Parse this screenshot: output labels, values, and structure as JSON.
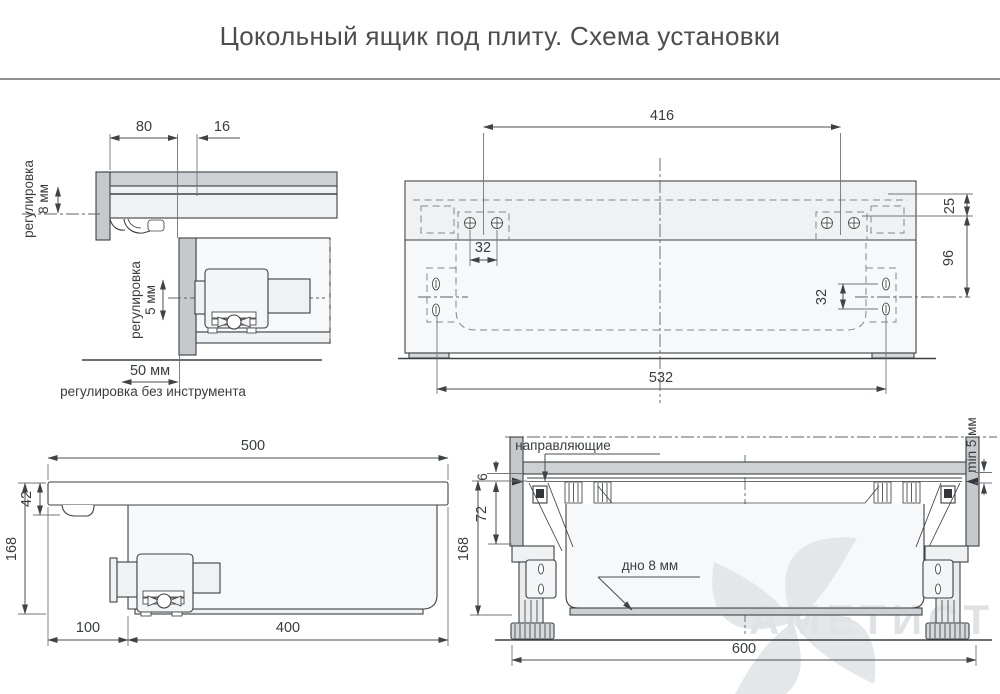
{
  "title": "Цокольный ящик под плиту. Схема установки",
  "colors": {
    "background": "#ffffff",
    "divider": "#8e8e8e",
    "line": "#3d4145",
    "dimension": "#4a4e51",
    "panel_fill": "#c6c9cb",
    "light_fill": "#eff1f2",
    "watermark": "#dfe3e6"
  },
  "side_detail": {
    "dim_80": "80",
    "dim_16": "16",
    "adjust_8mm_line1": "регулировка",
    "adjust_8mm_line2": "8 мм",
    "adjust_5mm_line1": "регулировка",
    "adjust_5mm_line2": "5 мм",
    "dim_50mm": "50 мм",
    "note_toolless": "регулировка без инструмента"
  },
  "top_view": {
    "dim_416": "416",
    "dim_25": "25",
    "dim_96": "96",
    "dim_32_horizontal": "32",
    "dim_32_vertical": "32",
    "dim_532": "532"
  },
  "side_view": {
    "dim_500": "500",
    "dim_42": "42",
    "dim_168": "168",
    "dim_100": "100",
    "dim_400": "400"
  },
  "front_section": {
    "label_rails": "направляющие",
    "label_min_gap": "min 5 мм",
    "dim_6": "6",
    "dim_72": "72",
    "dim_168": "168",
    "label_bottom": "дно 8 мм",
    "dim_600": "600"
  },
  "watermark_text": "АМЕТИСТ"
}
